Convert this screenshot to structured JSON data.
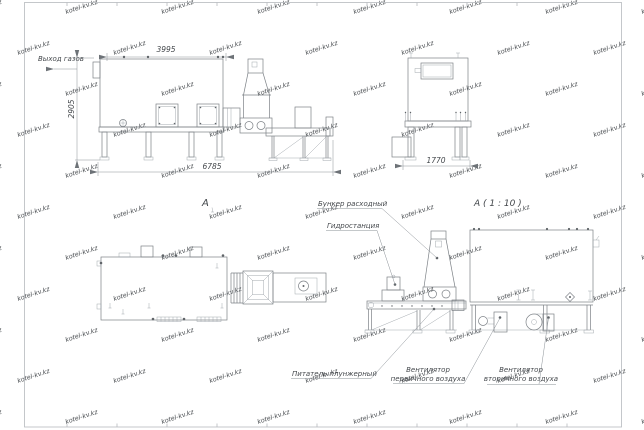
{
  "sheet": {
    "background": "#ffffff",
    "frame_color": "#b6babe",
    "line_color": "#7d8287",
    "text_color": "#44484c",
    "watermark": {
      "text": "kotel-kv.kz",
      "color": "#e2e6ea"
    }
  },
  "views": {
    "side": {
      "gas_outlet_label": "Выход газов",
      "dim_top": "3995",
      "dim_left": "2905",
      "dim_bottom": "6785"
    },
    "end": {
      "dim_bottom": "1770"
    },
    "plan": {
      "view_label": "А"
    },
    "detail": {
      "title": "А ( 1 : 10 )",
      "callouts": {
        "hopper": "Бункер расходный",
        "hydraulic": "Гидростанция",
        "feeder": "Питатель плунжерный",
        "primary_fan": [
          "Вентилятор",
          "первичного воздуха"
        ],
        "secondary_fan": [
          "Вентилятор",
          "вторичного воздуха"
        ]
      }
    }
  }
}
